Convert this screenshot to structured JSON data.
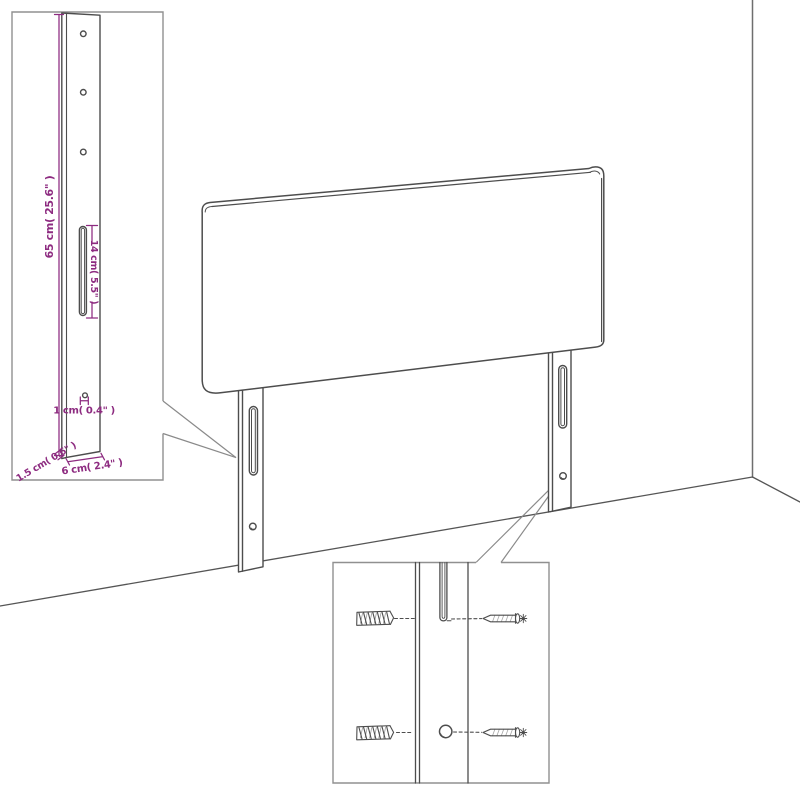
{
  "title": "Headboard wall-mounting technical diagram",
  "palette": {
    "background": "#ffffff",
    "line": "#4d4d4d",
    "dimension": "#8d2b80",
    "inset_border": "#909090",
    "callout": "#8a8a8a",
    "wall": "#6e6e6e",
    "floor": "#555555"
  },
  "post_detail": {
    "labels": {
      "height": "65 cm( 25.6\" )",
      "slot_height": "14 cm( 5.5\" )",
      "hole_diameter": "1 cm( 0.4\" )",
      "thickness": "1.5 cm( 0.6\" )",
      "width": "6 cm( 2.4\" )"
    }
  },
  "mount_detail": {
    "parts": [
      "wall-plug-anchor",
      "leg-slot",
      "leg-hole",
      "mounting-screw"
    ]
  }
}
